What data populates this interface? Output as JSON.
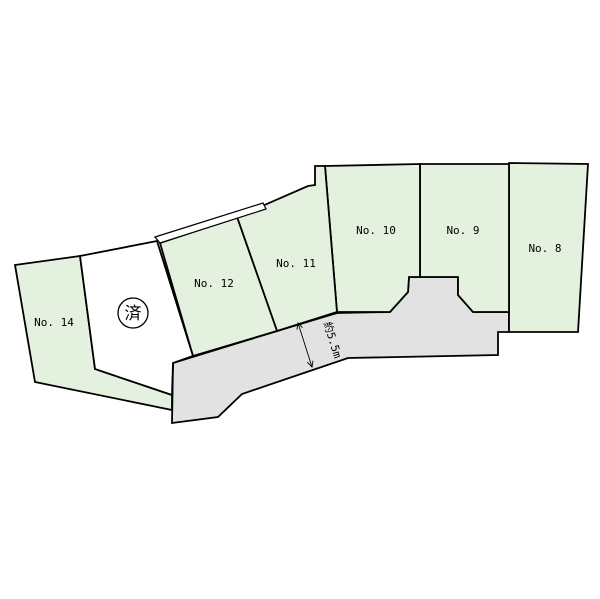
{
  "diagram": {
    "background": "#ffffff",
    "line_color": "#000000",
    "plot_fill": "#e3f1de",
    "road_fill": "#e2e2e2",
    "sold_fill": "#ffffff"
  },
  "plots": [
    {
      "id": "no8",
      "label": "No. 8",
      "points": "509,163 588,164 578,332 509,332",
      "label_x": 545,
      "label_y": 252
    },
    {
      "id": "no9",
      "label": "No. 9",
      "points": "420,164 509,164 509,312 473,312 458,295 458,277 420,277",
      "label_x": 463,
      "label_y": 234
    },
    {
      "id": "no10",
      "label": "No. 10",
      "points": "325,166 420,164 420,277 409,277 408,292 390,312 337,312",
      "label_x": 376,
      "label_y": 234
    },
    {
      "id": "no11",
      "label": "No. 11",
      "points": "237,217 308,186 315,185 315,166 325,166 337,312 277,331",
      "label_x": 296,
      "label_y": 267
    },
    {
      "id": "no12",
      "label": "No. 12",
      "points": "160,243 237,217 277,331 193,356",
      "label_x": 214,
      "label_y": 287
    },
    {
      "id": "no14",
      "label": "No. 14",
      "points": "15,265 80,256 95,369 172,395 172,410 35,382",
      "label_x": 54,
      "label_y": 326
    }
  ],
  "sold_plot": {
    "points": "80,256 157,241 193,356 173,363 172,395 95,369",
    "stamp": "済",
    "stamp_cx": 133,
    "stamp_cy": 313,
    "stamp_r": 15,
    "stamp_text_y": 319
  },
  "road": {
    "points": "173,363 277,331 337,313 390,312 408,292 409,277 458,277 458,295 473,312 509,312 509,332 498,332 498,355 348,358 242,394 218,417 172,423"
  },
  "strip": {
    "points": "155,237 263,203 266,209 160,243"
  },
  "dimension": {
    "label": "約5.5m",
    "x1": 298,
    "y1": 323,
    "x2": 312,
    "y2": 367,
    "transform": "translate(329,341) rotate(73)"
  }
}
